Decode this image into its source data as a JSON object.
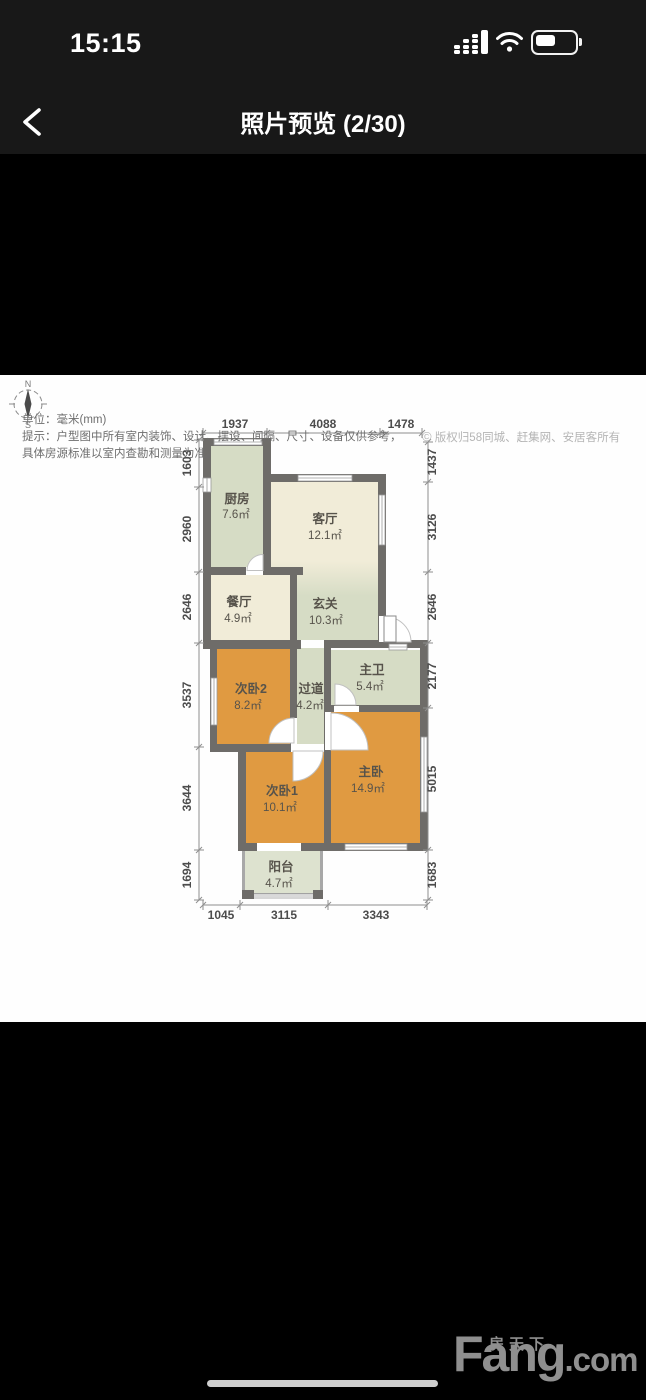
{
  "status_bar": {
    "time": "15:15",
    "icons": [
      "cellular-signal-icon",
      "wifi-icon",
      "battery-icon"
    ],
    "battery_fill_ratio": 0.5
  },
  "nav": {
    "title": "照片预览 (2/30)"
  },
  "footer": {
    "unit_note": "单位：毫米(mm)",
    "tip_line1": "提示：户型图中所有室内装饰、设计、摆设、间隔、尺寸、设备仅供参考，",
    "tip_line2": "具体房源标准以室内查勘和测量为准。",
    "copyright_symbol": "©",
    "copyright": "版权归58同城、赶集网、安居客所有"
  },
  "watermark": {
    "zh": "房天下",
    "en_main": "Fang",
    "en_suffix": ".com"
  },
  "plan": {
    "colors": {
      "orange": "#e09a41",
      "green": "#d6dcc5",
      "pale": "#dde2cf",
      "cream": "#f1ecd8",
      "wall": "#6e6c69",
      "thinwall": "#a8a8a8",
      "dim_text": "#4c4c4c",
      "dim_line": "#8f8f8f",
      "label_text": "#57534b"
    },
    "compass": {
      "cx": 28,
      "cy": 404,
      "r": 14,
      "n": "N",
      "s": "S"
    },
    "rooms": [
      {
        "id": "kitchen",
        "name": "厨房",
        "area": "7.6㎡",
        "rect": [
          210,
          445,
          53,
          122
        ],
        "fill": "green",
        "nx": 237,
        "ny": 503,
        "ax": 236,
        "ay": 518
      },
      {
        "id": "living",
        "name": "客厅",
        "area": "12.1㎡",
        "rect": [
          270,
          482,
          108,
          158
        ],
        "fill": "living-gradient",
        "nx": 325,
        "ny": 523,
        "ax": 325,
        "ay": 539
      },
      {
        "id": "dining",
        "name": "餐厅",
        "area": "4.9㎡",
        "rect": [
          210,
          575,
          80,
          65
        ],
        "fill": "cream",
        "nx": 239,
        "ny": 606,
        "ax": 238,
        "ay": 622
      },
      {
        "id": "foyer",
        "name": "玄关",
        "area": "10.3㎡",
        "rect": null,
        "fill": "green",
        "nx": 325,
        "ny": 608,
        "ax": 326,
        "ay": 624
      },
      {
        "id": "bed2",
        "name": "次卧2",
        "area": "8.2㎡",
        "rect": [
          217,
          649,
          73,
          95
        ],
        "fill": "orange",
        "nx": 251,
        "ny": 693,
        "ax": 248,
        "ay": 709
      },
      {
        "id": "corridor",
        "name": "过道",
        "area": "4.2㎡",
        "rect": [
          297,
          648,
          27,
          122
        ],
        "fill": "green",
        "nx": 311,
        "ny": 693,
        "ax": 310,
        "ay": 709
      },
      {
        "id": "bath",
        "name": "主卫",
        "area": "5.4㎡",
        "rect": [
          331,
          650,
          89,
          55
        ],
        "fill": "green",
        "nx": 372,
        "ny": 674,
        "ax": 370,
        "ay": 690
      },
      {
        "id": "master",
        "name": "主卧",
        "area": "14.9㎡",
        "rect": [
          331,
          712,
          89,
          131
        ],
        "fill": "orange",
        "nx": 371,
        "ny": 776,
        "ax": 368,
        "ay": 792
      },
      {
        "id": "bed1",
        "name": "次卧1",
        "area": "10.1㎡",
        "rect": [
          245,
          752,
          79,
          95
        ],
        "fill": "orange",
        "nx": 282,
        "ny": 795,
        "ax": 280,
        "ay": 811
      },
      {
        "id": "balcony",
        "name": "阳台",
        "area": "4.7㎡",
        "rect": [
          244,
          851,
          77,
          44
        ],
        "fill": "pale",
        "nx": 281,
        "ny": 871,
        "ax": 279,
        "ay": 887
      }
    ],
    "walls": [
      [
        203,
        438,
        67,
        8
      ],
      [
        203,
        438,
        8,
        210
      ],
      [
        203,
        640,
        98,
        9
      ],
      [
        210,
        648,
        7,
        99
      ],
      [
        210,
        744,
        81,
        8
      ],
      [
        238,
        748,
        8,
        99
      ],
      [
        238,
        843,
        190,
        8
      ],
      [
        420,
        644,
        8,
        207
      ],
      [
        327,
        640,
        101,
        8
      ],
      [
        378,
        474,
        8,
        172
      ],
      [
        263,
        474,
        123,
        8
      ],
      [
        263,
        438,
        8,
        137
      ],
      [
        203,
        567,
        100,
        8
      ],
      [
        290,
        567,
        7,
        81
      ],
      [
        290,
        640,
        7,
        110
      ],
      [
        324,
        640,
        7,
        72
      ],
      [
        324,
        705,
        104,
        7
      ],
      [
        324,
        708,
        7,
        139
      ]
    ],
    "balcony_walls": [
      [
        242,
        851,
        3,
        46
      ],
      [
        320,
        851,
        3,
        46
      ],
      [
        242,
        893,
        81,
        4
      ]
    ],
    "windows": [
      [
        214,
        439,
        48,
        6
      ],
      [
        203,
        478,
        8,
        14
      ],
      [
        298,
        475,
        54,
        6
      ],
      [
        379,
        495,
        6,
        50
      ],
      [
        389,
        644,
        18,
        6
      ],
      [
        421,
        737,
        6,
        75
      ],
      [
        345,
        844,
        62,
        6
      ],
      [
        211,
        678,
        6,
        47
      ],
      [
        251,
        894,
        70,
        4
      ]
    ],
    "gaps": [
      [
        246,
        567,
        17,
        8
      ],
      [
        379,
        616,
        7,
        26
      ],
      [
        325,
        712,
        6,
        38
      ],
      [
        291,
        718,
        6,
        27
      ],
      [
        334,
        706,
        25,
        6
      ],
      [
        257,
        843,
        44,
        8
      ],
      [
        291,
        744,
        33,
        8
      ]
    ],
    "fans": [
      "M 263 570.5 L 247 570.5 A 16 16 0 0 1 263 554.5 Z",
      "M 386 617 A 25 25 0 0 1 411 642 L 386 642 Z",
      "M 294 743 L 294 718 A 25 25 0 0 0 269 743 Z",
      "M 331 713 A 37 37 0 0 1 368 750 L 331 750 Z",
      "M 293 751 L 323 751 A 30 30 0 0 1 293 781 Z",
      "M 335 705 L 335 684 A 21 21 0 0 1 356 705 Z"
    ],
    "door_leaf": [
      384,
      616,
      12,
      26
    ],
    "posts": [
      [
        242,
        890,
        12,
        9
      ],
      [
        313,
        890,
        10,
        9
      ]
    ],
    "dims": {
      "top": {
        "line_y": 433,
        "label_y": 428,
        "ticks": [
          203,
          267,
          380,
          422
        ],
        "labels": [
          {
            "t": "1937",
            "x": 235
          },
          {
            "t": "4088",
            "x": 323
          },
          {
            "t": "1478",
            "x": 401
          }
        ]
      },
      "bottom": {
        "line_y": 905,
        "label_y": 919,
        "ticks": [
          203,
          240,
          328,
          427
        ],
        "labels": [
          {
            "t": "1045",
            "x": 221
          },
          {
            "t": "3115",
            "x": 284
          },
          {
            "t": "3343",
            "x": 376
          }
        ]
      },
      "left": {
        "line_x": 199,
        "label_x": 191,
        "ticks": [
          440,
          487,
          572,
          643,
          747,
          850,
          900
        ],
        "labels": [
          {
            "t": "1603",
            "y": 463
          },
          {
            "t": "2960",
            "y": 529
          },
          {
            "t": "2646",
            "y": 607
          },
          {
            "t": "3537",
            "y": 695
          },
          {
            "t": "3644",
            "y": 798
          },
          {
            "t": "1694",
            "y": 875
          }
        ]
      },
      "right": {
        "line_x": 428,
        "label_x": 436,
        "ticks": [
          442,
          482,
          572,
          643,
          708,
          850,
          900
        ],
        "labels": [
          {
            "t": "1437",
            "y": 462
          },
          {
            "t": "3126",
            "y": 527
          },
          {
            "t": "2646",
            "y": 607
          },
          {
            "t": "2177",
            "y": 676
          },
          {
            "t": "5015",
            "y": 779
          },
          {
            "t": "1683",
            "y": 875
          }
        ]
      }
    }
  }
}
